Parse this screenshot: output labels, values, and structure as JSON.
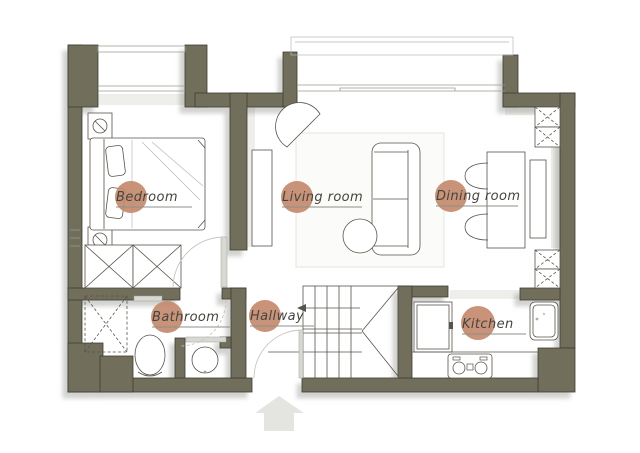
{
  "floorplan": {
    "title": "apartment-floor-plan",
    "rooms": [
      {
        "id": "bedroom",
        "label": "Bedroom"
      },
      {
        "id": "living-room",
        "label": "Living room"
      },
      {
        "id": "dining-room",
        "label": "Dining room"
      },
      {
        "id": "bathroom",
        "label": "Bathroom"
      },
      {
        "id": "hallway",
        "label": "Hallway"
      },
      {
        "id": "kitchen",
        "label": "Kitchen"
      }
    ],
    "colors": {
      "wall": "#716e5b",
      "wall_outline": "#3e3d33",
      "label_circle": "#c38a6c",
      "label_text": "#45453f",
      "furniture_line": "#57544b",
      "shadow": "rgba(95,95,85,0.28)",
      "background": "#ffffff"
    },
    "icons": [
      "bed-icon",
      "pillow-icon",
      "nightstand-lamp-icon",
      "wardrobe-x-icon",
      "tv-console-icon",
      "armchair-icon",
      "sofa-icon",
      "coffee-table-icon",
      "rug-icon",
      "dining-table-icon",
      "dining-chair-icon",
      "sideboard-icon",
      "shaft-x-icon",
      "shower-icon",
      "toilet-icon",
      "washbasin-icon",
      "stairs-icon",
      "stair-arrow-icon",
      "fridge-icon",
      "kitchen-sink-icon",
      "stove-icon",
      "window-icon",
      "balcony-slider-icon",
      "door-swing-icon",
      "entrance-arrow-icon"
    ]
  }
}
